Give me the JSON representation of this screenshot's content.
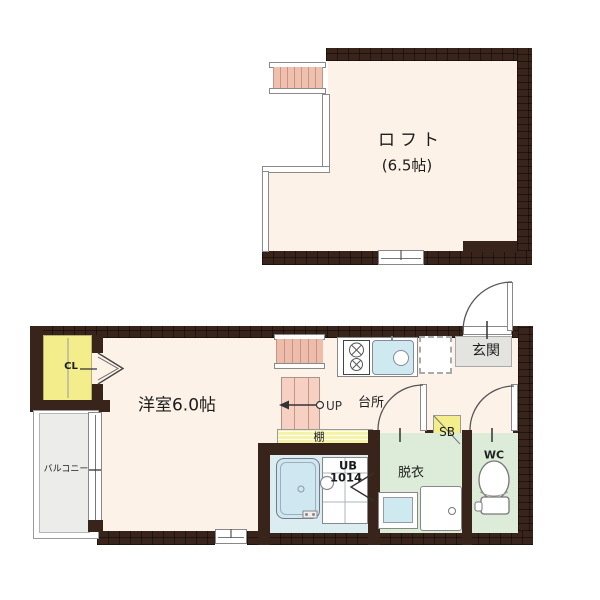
{
  "labels": {
    "loft": "ロフト",
    "loft_size": "(6.5帖)",
    "western_room": "洋室6.0帖",
    "kitchen": "台所",
    "entrance": "玄関",
    "dressing_room": "脱衣",
    "toilet": "WC",
    "unit_bath": "UB",
    "unit_bath_size": "1014",
    "shoe_box": "SB",
    "shelf": "棚",
    "stairs_up": "UP",
    "closet": "CL",
    "balcony": "バルコニー"
  },
  "colors": {
    "wall_brown": "#38241a",
    "floor_cream": "#fdf2e8",
    "stairs_pink": "#efc0ae",
    "stairs_pink_light": "#f6d0c2",
    "closet_yellow": "#f3ee8b",
    "shelf_yellow": "#f6f2a8",
    "balcony_gray": "#ececea",
    "entrance_gray": "#e3e3df",
    "wet_room_green": "#dcecd8",
    "bath_blue": "#dcedf2",
    "tub_blue": "#cfe7f0",
    "sink_blue": "#cfe9f1"
  }
}
